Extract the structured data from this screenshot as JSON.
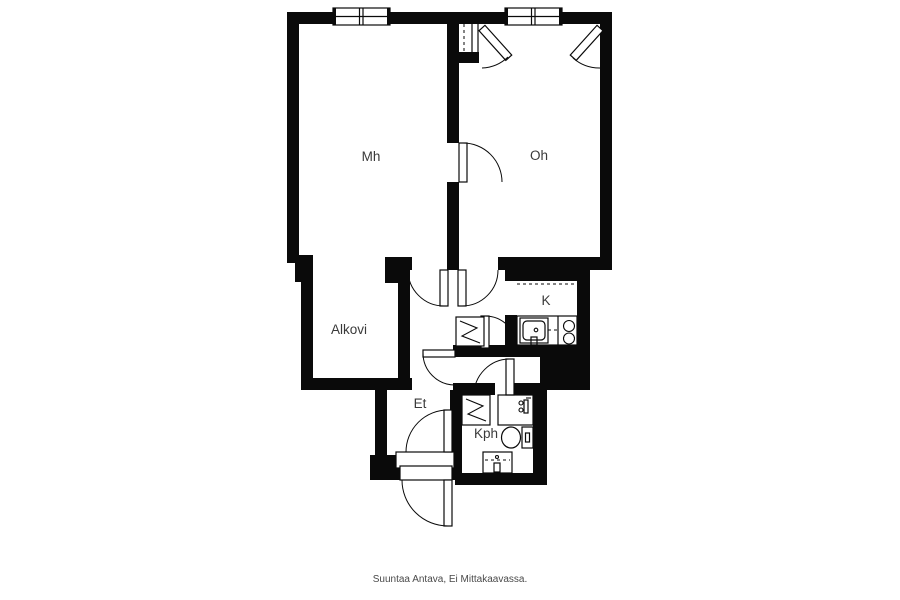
{
  "plan": {
    "title": "apartment-floorplan",
    "rooms": [
      {
        "id": "mh",
        "label": "Mh"
      },
      {
        "id": "oh",
        "label": "Oh"
      },
      {
        "id": "alkovi",
        "label": "Alkovi"
      },
      {
        "id": "k",
        "label": "K"
      },
      {
        "id": "et",
        "label": "Et"
      },
      {
        "id": "kph",
        "label": "Kph"
      }
    ],
    "caption": "Suuntaa Antava, Ei Mittakaavassa.",
    "colors": {
      "wall": "#0a0a0a",
      "background": "#ffffff",
      "label": "#3a3a3a",
      "caption": "#4a4a4a"
    },
    "symbols": {
      "door": "quarter-circle-swing-arc",
      "window": "double-pane-wall-inset",
      "closet": "square-with-zigzag",
      "water_heater": "square-with-zigzag",
      "stove": "two-burner-circles",
      "kitchen_sink": "rounded-basin-with-faucet",
      "shower": "thin-square-with-mixer",
      "toilet": "bowl-and-tank",
      "bath_sink": "basin-with-dashed-edge",
      "flue": "dashed-line-shaft"
    }
  }
}
